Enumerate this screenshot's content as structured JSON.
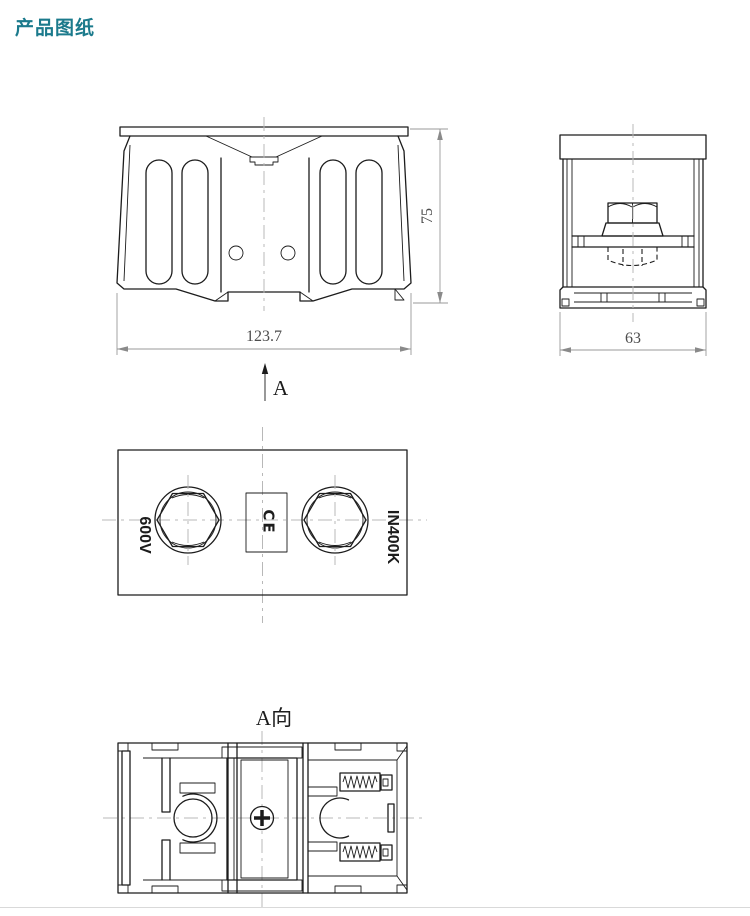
{
  "page": {
    "title": "产品图纸"
  },
  "theme": {
    "title_color": "#1b7a8c",
    "line_color": "#1c1c1c",
    "dim_line_color": "#9a9a9a",
    "dim_text_color": "#4d4d4d",
    "centerline_color": "#b8b8b8",
    "background": "#ffffff"
  },
  "views": {
    "front": {
      "width_dim": "123.7",
      "height_dim": "75"
    },
    "side": {
      "width_dim": "63"
    },
    "top": {
      "left_marking": "600V",
      "right_marking": "IN400K",
      "ce_marking": "CE"
    },
    "section": {
      "arrow_label": "A",
      "view_label": "A向"
    }
  }
}
